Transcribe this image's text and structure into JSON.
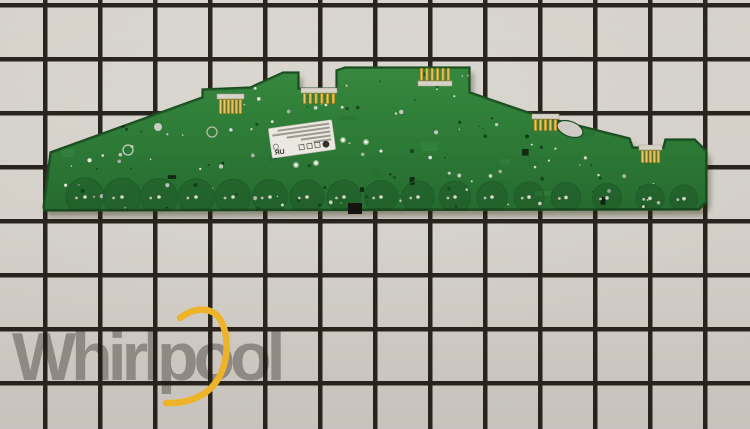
{
  "scene": {
    "type": "product-photo",
    "subject": "green electronic control board (PCB) lying on a black-grid cutting mat",
    "background": {
      "tile_color": "#d3cfc8",
      "grid_line_color": "#1b1610",
      "cell_width_px": 55,
      "cell_height_px": 54
    }
  },
  "watermark": {
    "brand": "Whirlpool",
    "text_color": "#8b8680",
    "swoosh_color": "#edb429"
  },
  "pcb": {
    "board_color": "#2e7c37",
    "board_edge_color": "#1d5827",
    "via_dot_color": "#ccd3c5",
    "connector_body_color": "#d8d3c8",
    "connector_pin_color": "#c79f2c",
    "connector_count": 5,
    "touch_pad_count": 17,
    "label": {
      "bg_color": "#eae8e1",
      "certification_mark": "ЯU",
      "text_legible": false
    }
  }
}
